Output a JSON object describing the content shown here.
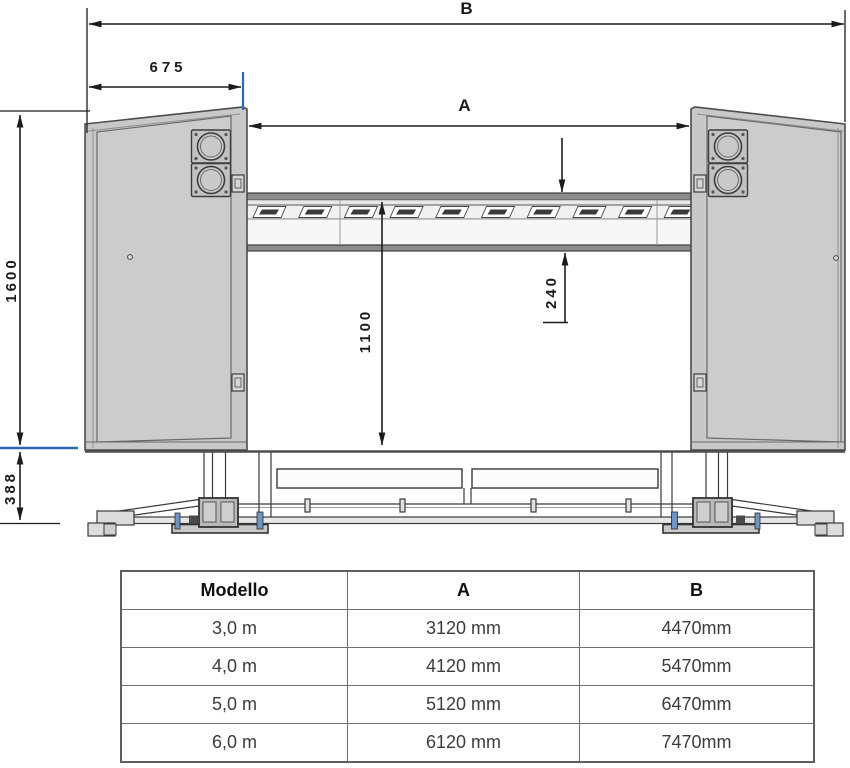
{
  "diagram": {
    "labels": {
      "b": "B",
      "a": "A",
      "offset_675": "675",
      "height_1600": "1600",
      "height_1100": "1100",
      "depth_240": "240",
      "base_388": "388"
    },
    "colors": {
      "line": "#1c1c1c",
      "blue_accent": "#2d68b0",
      "cabinet_fill": "#c8c8c8"
    }
  },
  "spec_table": {
    "headers": {
      "model": "Modello",
      "a": "A",
      "b": "B"
    },
    "rows": [
      {
        "model": "3,0 m",
        "a": "3120 mm",
        "b": "4470mm"
      },
      {
        "model": "4,0 m",
        "a": "4120 mm",
        "b": "5470mm"
      },
      {
        "model": "5,0 m",
        "a": "5120 mm",
        "b": "6470mm"
      },
      {
        "model": "6,0 m",
        "a": "6120 mm",
        "b": "7470mm"
      }
    ]
  }
}
